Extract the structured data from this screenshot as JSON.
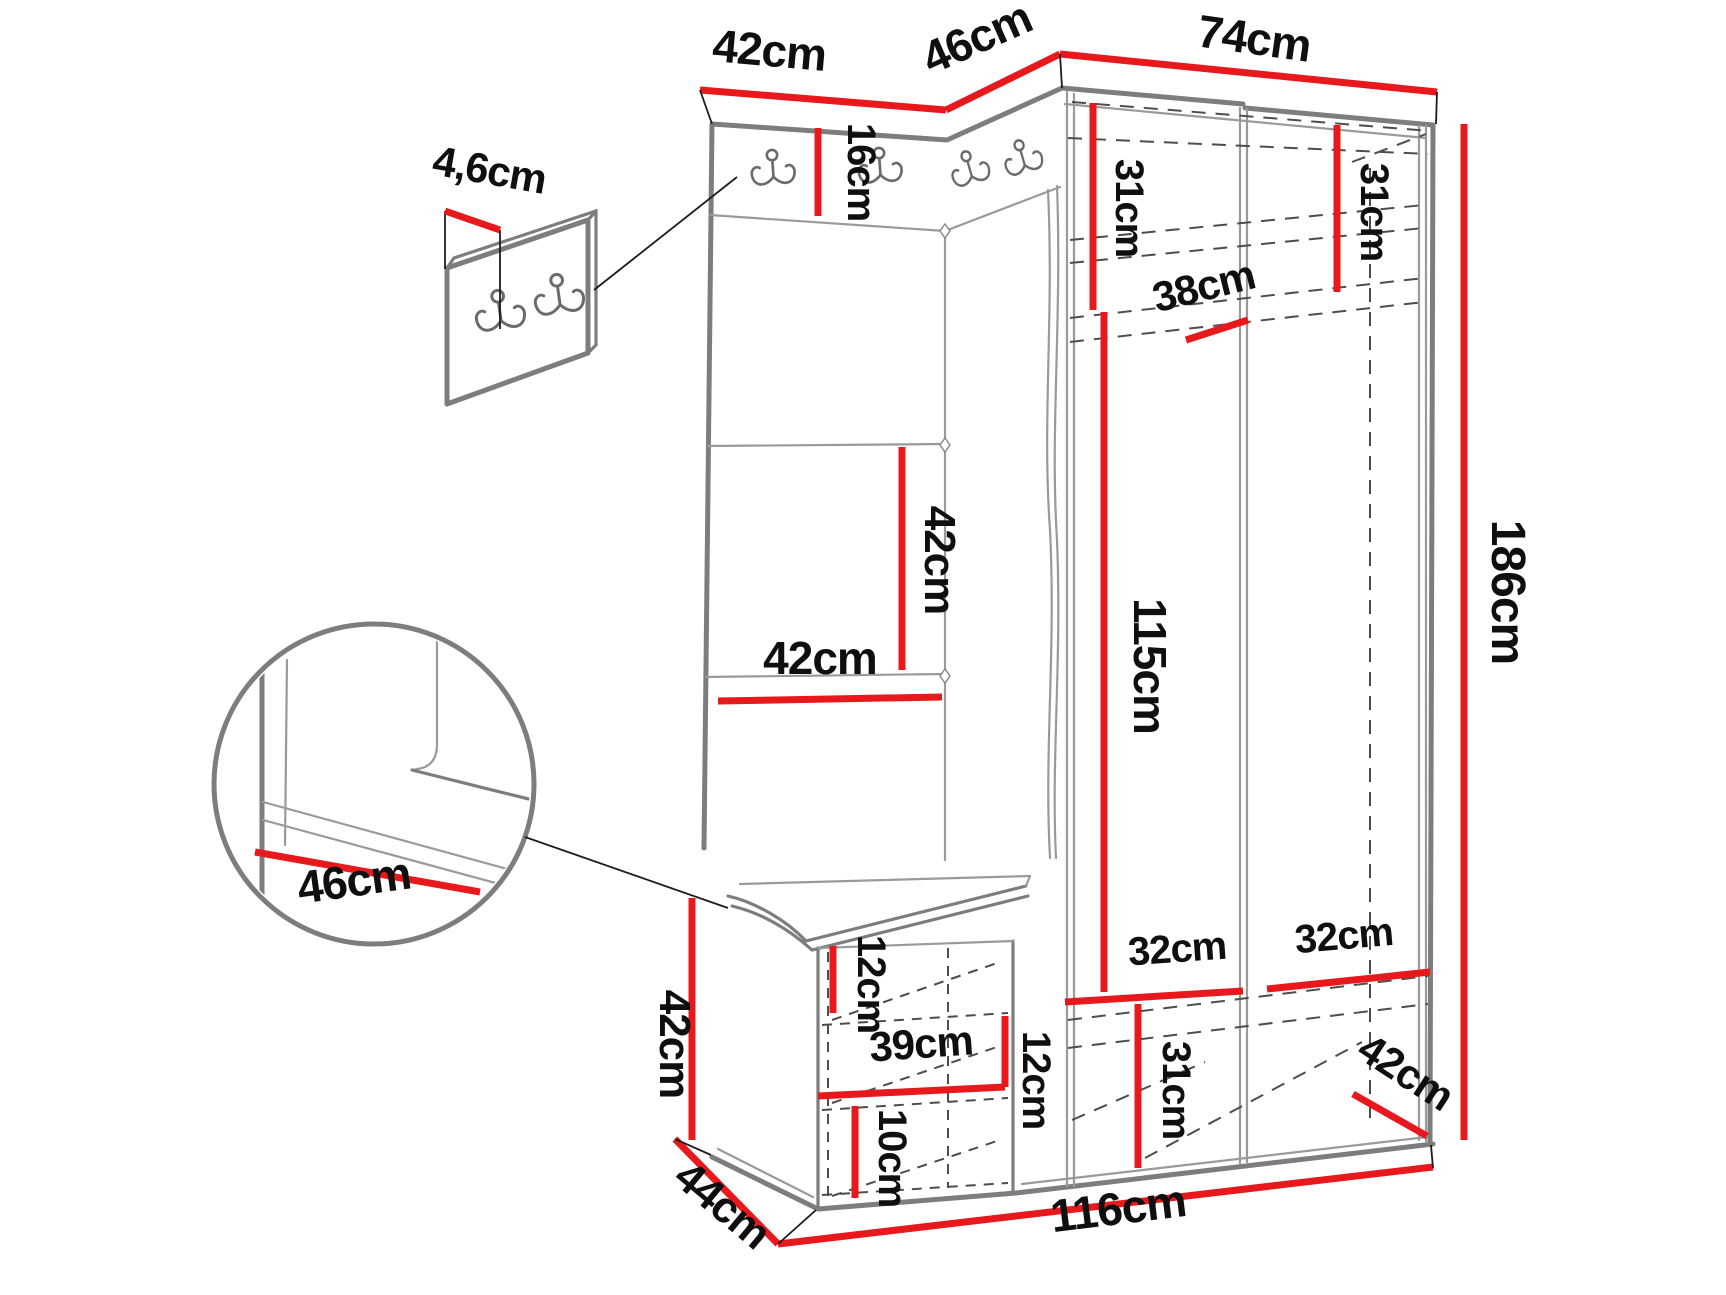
{
  "diagram": {
    "type": "furniture-dimension-diagram",
    "subject": "hallway corner wardrobe set with coat-hook rail, upholstered panels and shoe bench",
    "unit": "cm",
    "views": [
      "main wardrobe drawing",
      "hook panel thickness detail",
      "bench corner detail (circle)"
    ],
    "icons": {
      "coat_hook": "double-coat-hook-icon",
      "main_unit_hook_count": 4,
      "detail_panel_hook_count": 2
    },
    "colors": {
      "background": "#ffffff",
      "dimension_line": "#e8191c",
      "outline": "#7d7d7d",
      "extension_line": "#1c1c1c",
      "dashed_line": "#4d4d4d",
      "label_text": "#0f0f0f"
    }
  },
  "labels": {
    "top_width_left": "42cm",
    "top_depth_corner": "46cm",
    "top_width_right": "74cm",
    "panel_thickness": "4,6cm",
    "hook_rail_height": "16cm",
    "upper_shelf_left_height": "31cm",
    "upper_shelf_right_height": "31cm",
    "upper_shelf_depth": "38cm",
    "panel_tile_height": "42cm",
    "panel_tile_width": "42cm",
    "door_height": "115cm",
    "total_height": "186cm",
    "seat_depth_detail": "46cm",
    "bench_height": "42cm",
    "bench_top_offset": "12cm",
    "bench_inner_width": "39cm",
    "bench_shelf_spacing": "12cm",
    "bench_bottom_offset": "10cm",
    "bottom_shelf_left_width": "32cm",
    "bottom_shelf_right_width": "32cm",
    "bottom_compartment_height": "31cm",
    "side_depth_bottom": "42cm",
    "bench_depth": "44cm",
    "total_width_bottom": "116cm"
  }
}
